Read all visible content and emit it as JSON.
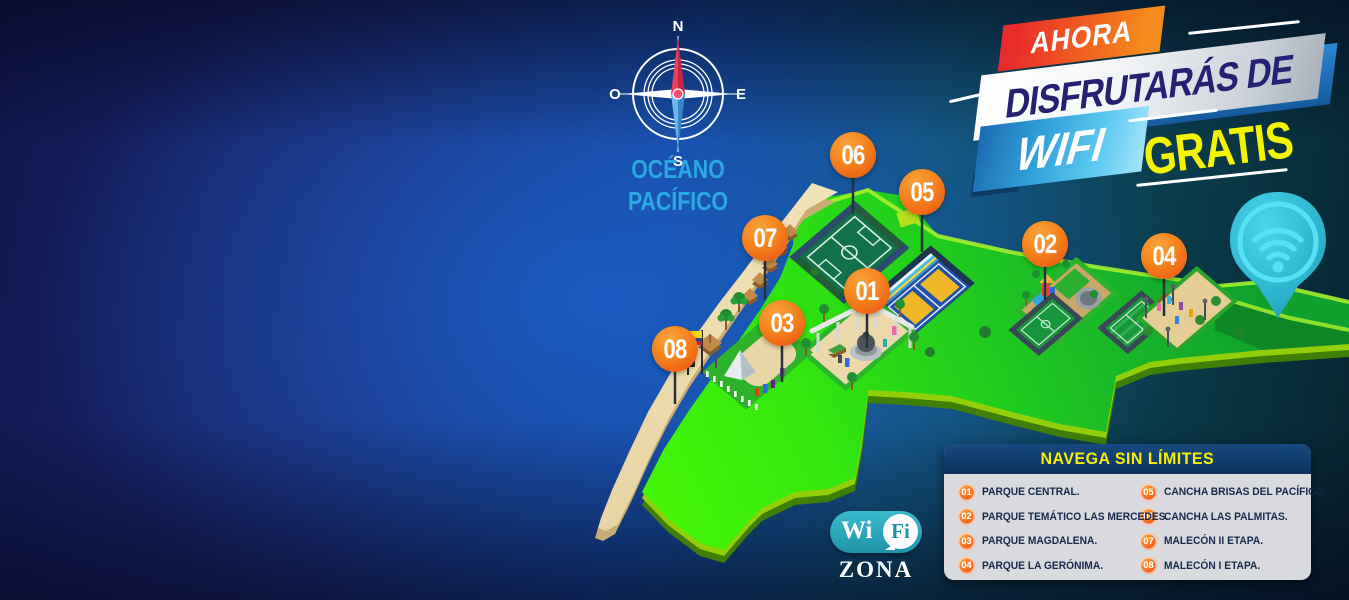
{
  "header": {
    "line1": "AHORA",
    "line2": "DISFRUTARÁS DE",
    "line3": "WIFI",
    "line4": "GRATIS"
  },
  "ocean": {
    "line1": "OCÉANO",
    "line2": "PACÍFICO"
  },
  "compass": {
    "n": "N",
    "s": "S",
    "e": "E",
    "o": "O"
  },
  "map_markers": [
    "01",
    "02",
    "03",
    "04",
    "05",
    "06",
    "07",
    "08"
  ],
  "legend": {
    "title": "NAVEGA SIN LÍMITES",
    "items": [
      {
        "number": "01",
        "label": "PARQUE CENTRAL."
      },
      {
        "number": "02",
        "label": "PARQUE TEMÁTICO LAS MERCEDES."
      },
      {
        "number": "03",
        "label": "PARQUE MAGDALENA."
      },
      {
        "number": "04",
        "label": "PARQUE LA GERÓNIMA."
      },
      {
        "number": "05",
        "label": "CANCHA BRISAS DEL PACÍFICO."
      },
      {
        "number": "06",
        "label": "CANCHA LAS PALMITAS."
      },
      {
        "number": "07",
        "label": "MALECÓN II ETAPA."
      },
      {
        "number": "08",
        "label": "MALECÓN I ETAPA."
      }
    ]
  },
  "wifi_logo": {
    "wi": "Wi",
    "fi": "Fi",
    "zona": "ZONA"
  },
  "colors": {
    "marker_orange": "#f4831e",
    "accent_red": "#e82b2b",
    "accent_orange": "#f58a1d",
    "accent_yellow": "#f4f400",
    "accent_cyan": "#2aa9e1",
    "headline_navy": "#262073",
    "legend_header": "#0e335c",
    "legend_bg": "#d8dade",
    "wifi_teal": "#1f93a8",
    "land_green": "#2fd40e"
  }
}
